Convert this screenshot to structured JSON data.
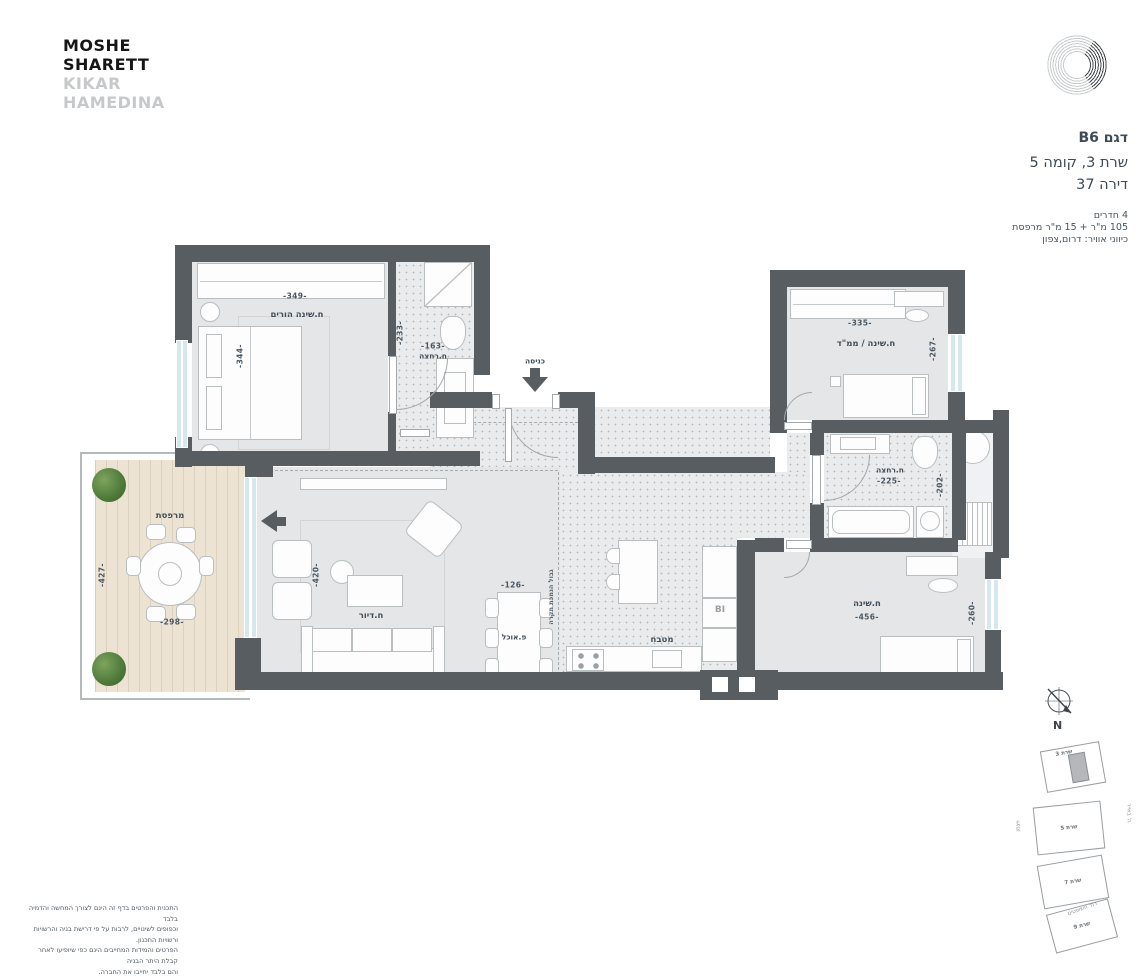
{
  "brand": {
    "line1": "MOSHE",
    "line2": "SHARETT",
    "line3": "KIKAR",
    "line4": "HAMEDINA"
  },
  "unit_info": {
    "model": "דגם B6",
    "building_floor": "שרת 3, קומה 5",
    "apartment": "דירה 37",
    "rooms": "4 חדרים",
    "area": "105 מ\"ר + 15 מ\"ר מרפסת",
    "directions": "כיווני אוויר: דרום,צפון"
  },
  "plan": {
    "entrance": "כניסה",
    "ceiling_note": "גבול הנמכת תקרה",
    "master_bedroom": {
      "label": "ח.שינה הורים",
      "dim_w": "-349-",
      "dim_h": "-344-"
    },
    "master_bath": {
      "label": "ח.רחצה",
      "dim_w": "-163-",
      "dim_h": "-233-"
    },
    "living": {
      "label": "ח.דיור",
      "dim_h": "-420-"
    },
    "balcony": {
      "label": "מרפסת",
      "dim_w": "-298-",
      "dim_h": "-427-"
    },
    "dining": {
      "label": "פ.אוכל",
      "dim_w": "-126-"
    },
    "kitchen": {
      "label": "מטבח",
      "fridge": "BI"
    },
    "mamad": {
      "label": "ח.שינה / ממ\"ד",
      "dim_w": "-335-",
      "dim_h": "-267-"
    },
    "bath2": {
      "label": "ח.רחצה",
      "dim_w": "-225-",
      "dim_h": "-202-"
    },
    "bedroom3": {
      "label": "ח.שינה",
      "dim_w": "-456-",
      "dim_h": "-260-"
    }
  },
  "compass": {
    "north": "N"
  },
  "site_plan": {
    "buildings": [
      "שרת 3",
      "שרת 5",
      "שרת 7",
      "שרת 9"
    ],
    "street_left": "ויצמן",
    "street_right": "ה' באייר",
    "street_bottom": "רח' השופטים"
  },
  "disclaimer": {
    "lines": [
      "התכנית והפרטים בדף זה הינם לצורך המחשה והדמיה בלבד",
      "וכפופים לשינויים, לרבות על פי דרישת בניה והרשויות ורשויות התכנון.",
      "הפרטים והמידות המחייבים הינם כפי שיופיעו לאחר קבלת היתר הבניה",
      "והם בלבד יחייבו את החברה."
    ]
  },
  "colors": {
    "wall": "#585d61",
    "floor": "#e4e6e7",
    "wood": "#ece3d3",
    "glass": "#d6e7ee",
    "accent_text": "#3f4d59"
  }
}
